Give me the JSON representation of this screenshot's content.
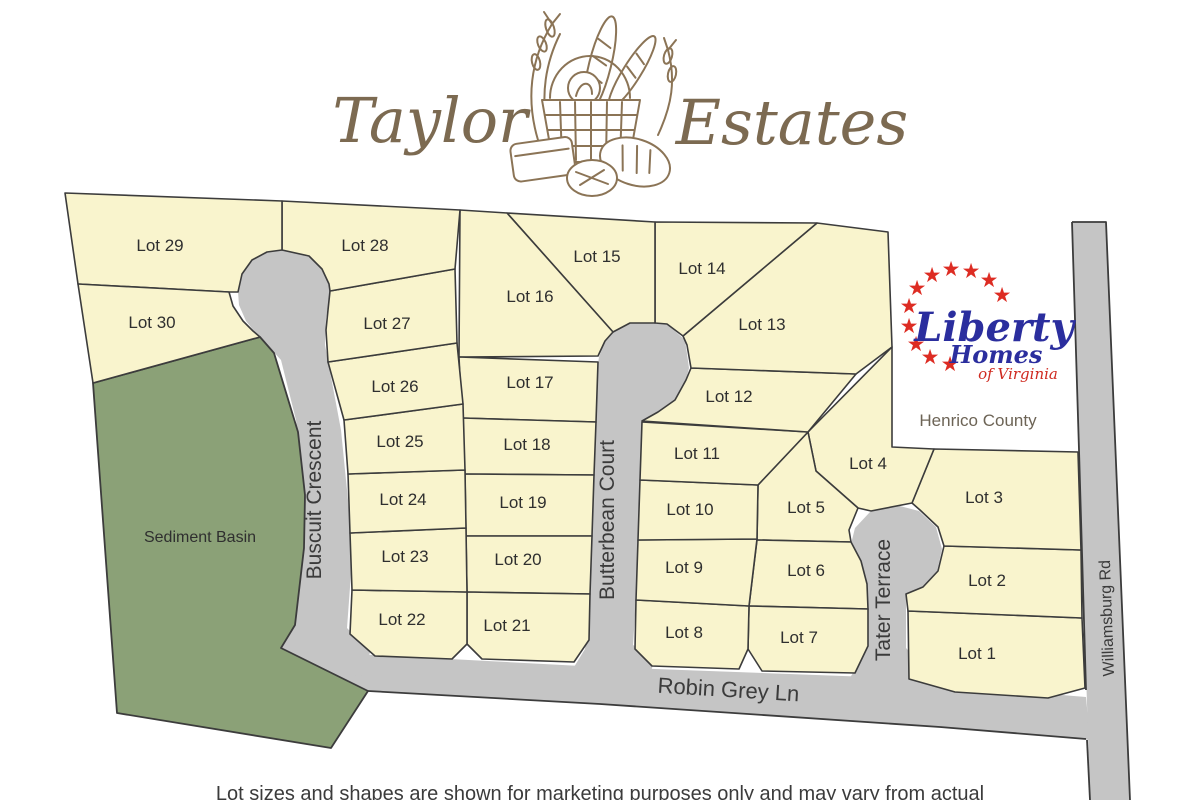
{
  "header": {
    "title_left": "Taylor",
    "title_right": "Estates"
  },
  "logo": {
    "brand": "Liberty",
    "homes": "Homes",
    "tagline": "of Virginia",
    "county": "Henrico County",
    "star": "★"
  },
  "map": {
    "basin_label": "Sediment Basin",
    "roads": {
      "buscuit": "Buscuit Crescent",
      "butterbean": "Butterbean Court",
      "tater": "Tater Terrace",
      "robin": "Robin Grey Ln",
      "williamsburg": "Williamsburg Rd"
    },
    "lots": [
      {
        "label": "Lot 1"
      },
      {
        "label": "Lot 2"
      },
      {
        "label": "Lot 3"
      },
      {
        "label": "Lot 4"
      },
      {
        "label": "Lot 5"
      },
      {
        "label": "Lot 6"
      },
      {
        "label": "Lot 7"
      },
      {
        "label": "Lot 8"
      },
      {
        "label": "Lot 9"
      },
      {
        "label": "Lot 10"
      },
      {
        "label": "Lot 11"
      },
      {
        "label": "Lot 12"
      },
      {
        "label": "Lot 13"
      },
      {
        "label": "Lot 14"
      },
      {
        "label": "Lot 15"
      },
      {
        "label": "Lot 16"
      },
      {
        "label": "Lot 17"
      },
      {
        "label": "Lot 18"
      },
      {
        "label": "Lot 19"
      },
      {
        "label": "Lot 20"
      },
      {
        "label": "Lot 21"
      },
      {
        "label": "Lot 22"
      },
      {
        "label": "Lot 23"
      },
      {
        "label": "Lot 24"
      },
      {
        "label": "Lot 25"
      },
      {
        "label": "Lot 26"
      },
      {
        "label": "Lot 27"
      },
      {
        "label": "Lot 28"
      },
      {
        "label": "Lot 29"
      },
      {
        "label": "Lot 30"
      }
    ]
  },
  "footer": {
    "disclaimer": "Lot sizes and shapes are shown for marketing purposes only and may vary from actual"
  },
  "colors": {
    "lot_fill": "#f9f4cd",
    "road_fill": "#c5c5c5",
    "basin_fill": "#8ba177",
    "line": "#3c3c3c",
    "title_brown": "#7c6a51",
    "logo_blue": "#2b2e9e",
    "logo_red": "#dd2c23"
  }
}
